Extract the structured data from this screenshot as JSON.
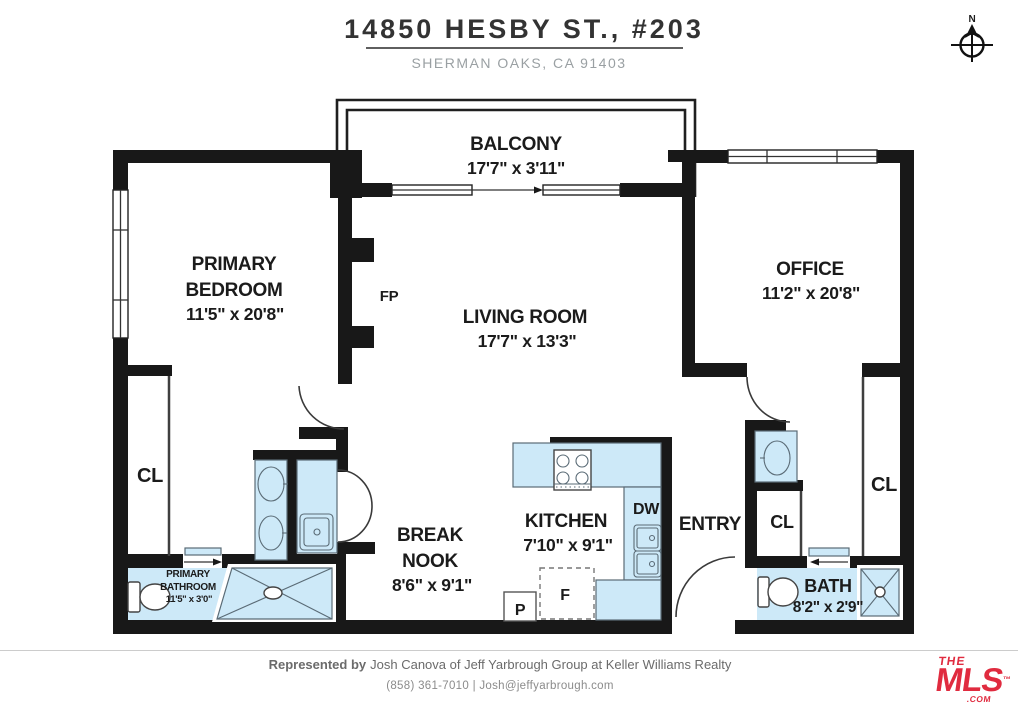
{
  "title": {
    "address": "14850 HESBY ST., #203",
    "city": "SHERMAN OAKS, CA 91403"
  },
  "compass": {
    "north": "N"
  },
  "rooms": {
    "balcony": {
      "name": "BALCONY",
      "dims": "17'7\" x 3'11\""
    },
    "primary_bedroom": {
      "line1": "PRIMARY",
      "line2": "BEDROOM",
      "dims": "11'5\" x 20'8\""
    },
    "living_room": {
      "name": "LIVING ROOM",
      "dims": "17'7\" x 13'3\""
    },
    "office": {
      "name": "OFFICE",
      "dims": "11'2\" x 20'8\""
    },
    "kitchen": {
      "name": "KITCHEN",
      "dims": "7'10\" x 9'1\""
    },
    "break_nook": {
      "line1": "BREAK",
      "line2": "NOOK",
      "dims": "8'6\" x 9'1\""
    },
    "bath": {
      "name": "BATH",
      "dims": "8'2\" x 2'9\""
    },
    "primary_bathroom": {
      "line1": "PRIMARY",
      "line2": "BATHROOM",
      "dims": "11'5\" x 3'0\""
    },
    "entry": {
      "name": "ENTRY"
    }
  },
  "labels": {
    "fireplace": "FP",
    "dishwasher": "DW",
    "pantry": "P",
    "refrigerator": "F",
    "closet_primary": "CL",
    "closet_entry": "CL",
    "closet_office": "CL"
  },
  "footer": {
    "represented_by": "Represented by",
    "agent_line": "Josh Canova of Jeff Yarbrough Group at Keller Williams Realty",
    "contact": "(858) 361-7010 | Josh@jeffyarbrough.com"
  },
  "logo": {
    "the": "THE",
    "name": "MLS",
    "tm": "™",
    "com": ".COM"
  },
  "colors": {
    "wall": "#181818",
    "fixture_blue": "#cde9f8",
    "fixture_stroke": "#5a6b76",
    "logo_red": "#e02b3f"
  }
}
